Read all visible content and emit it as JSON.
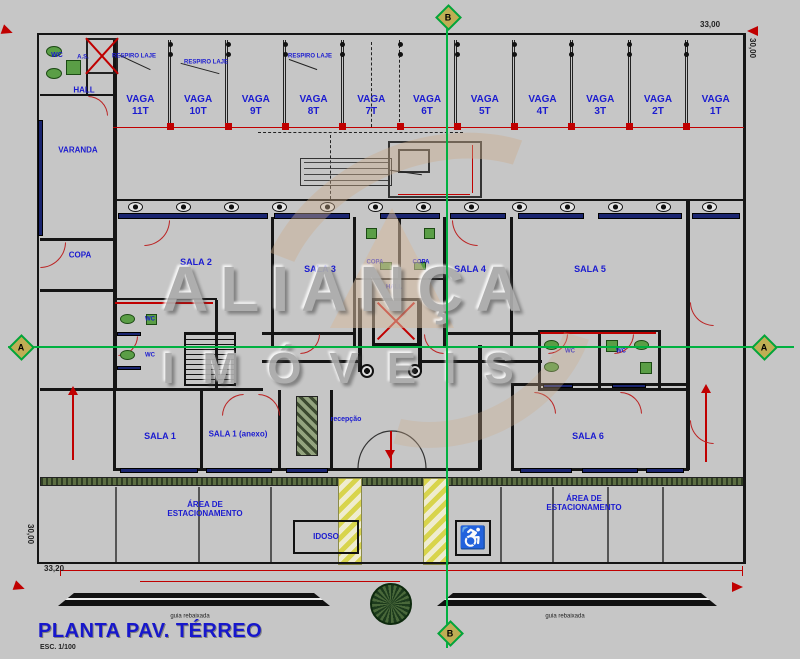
{
  "title": {
    "text": "PLANTA PAV. TÉRREO",
    "scale": "ESC. 1/100"
  },
  "watermark": {
    "line1": "ALIANÇA",
    "line2": "IMÓVEIS"
  },
  "markers": {
    "a": "A",
    "b": "B"
  },
  "parking": {
    "word": "VAGA",
    "stalls": [
      "11T",
      "10T",
      "9T",
      "8T",
      "7T",
      "6T",
      "5T",
      "4T",
      "3T",
      "2T",
      "1T"
    ]
  },
  "rooms": {
    "wc": "WC",
    "as": "A.S.",
    "hall": "HALL",
    "varanda": "VARANDA",
    "copa": "COPA",
    "sala2": "SALA 2",
    "sala3": "SALA 3",
    "sala4": "SALA 4",
    "sala5": "SALA 5",
    "sala1": "SALA 1",
    "sala1_anexo": "SALA 1 (anexo)",
    "sala6": "SALA 6",
    "recepcao": "recepção",
    "copa_small": "COPA",
    "hall_small": "HALL",
    "wc_small": "WC"
  },
  "annotations": {
    "respiro": "RESPIRO LAJE",
    "guia": "guia rebaixada",
    "idoso": "IDOSO"
  },
  "parking_area": {
    "line1": "ÁREA DE",
    "line2": "ESTACIONAMENTO"
  },
  "dims": {
    "top": "33,00",
    "right": "30,00",
    "bottom": "33,20",
    "left": "30,00"
  },
  "icons": {
    "wheelchair": "♿"
  },
  "colors": {
    "label_blue": "#1b1bd0",
    "dim_red": "#c00000",
    "section_green": "#00b140",
    "window_navy": "#1a2570",
    "background": "#c6c6c6"
  }
}
